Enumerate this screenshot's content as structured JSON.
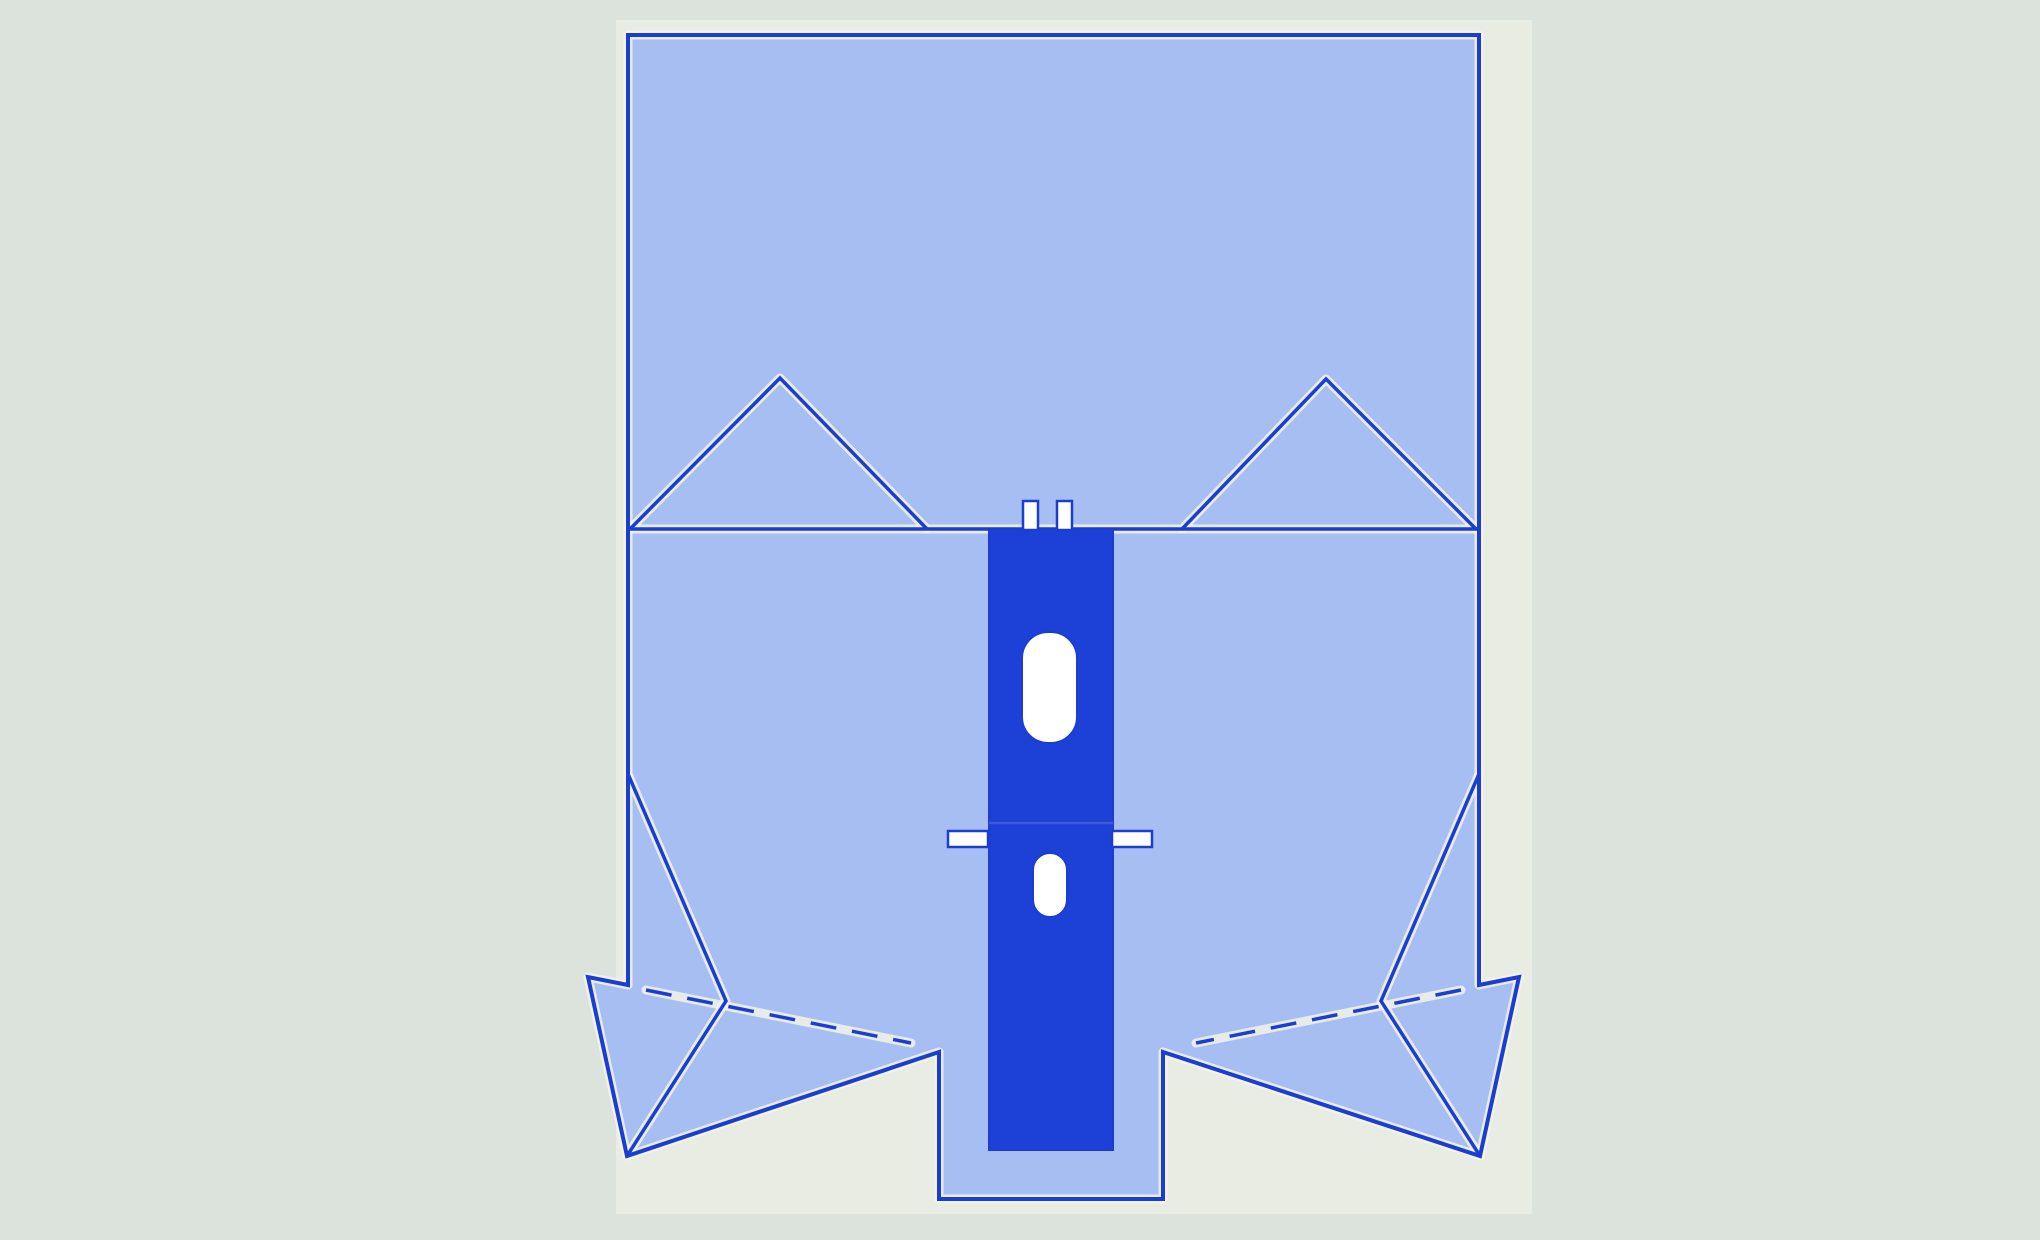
{
  "canvas": {
    "width": 2040,
    "height": 1240
  },
  "colors": {
    "background": "#dce3dd",
    "card": "#e9ece2",
    "drape_fill": "#a7bef2",
    "line_blue": "#1c3dd2",
    "strip_fill": "#1d41d7",
    "seam_blue": "#4058dd",
    "halo_cream": "#f2f4e7",
    "slot_white": "#ffffff"
  },
  "card": {
    "x": 616,
    "y": 20,
    "width": 916,
    "height": 1194
  },
  "drape": {
    "silhouette_path": "M628,35 L1479,35 L1479,985 L1519,977 L1480,1156 L1163,1052 L1163,1199 L939,1199 L939,1052 L627,1156 L588,977 L628,985 Z",
    "fold_line_path": "M628,529 L1479,529",
    "left_triangle_path": "M630,529 L780,378 L927,529",
    "right_triangle_path": "M1182,529 L1326,379 L1476,529",
    "left_corner_fold_path": "M628,774 L726,1001 L627,1156",
    "right_corner_fold_path": "M1479,774 L1381,1001 L1480,1156",
    "left_dashed_fold_path": "M646,990 L911,1043",
    "right_dashed_fold_path": "M1461,990 L1196,1043",
    "stroke_width": 4,
    "inner_stroke_width": 3.5,
    "halo_width": 9,
    "dash_pattern": "26 16"
  },
  "strip": {
    "x": 989,
    "y": 529,
    "width": 124,
    "height": 621,
    "seam_y": 823,
    "large_slot": {
      "x": 1022,
      "y": 632,
      "width": 55,
      "height": 111,
      "rx": 26
    },
    "small_slot": {
      "x": 1033,
      "y": 853,
      "width": 34,
      "height": 64,
      "rx": 17
    },
    "top_tabs": [
      {
        "x": 1023,
        "y": 501,
        "width": 15,
        "height": 29
      },
      {
        "x": 1057,
        "y": 501,
        "width": 15,
        "height": 29
      }
    ],
    "side_tabs": [
      {
        "x": 948,
        "y": 831,
        "width": 40,
        "height": 16
      },
      {
        "x": 1112,
        "y": 831,
        "width": 40,
        "height": 16
      }
    ]
  }
}
